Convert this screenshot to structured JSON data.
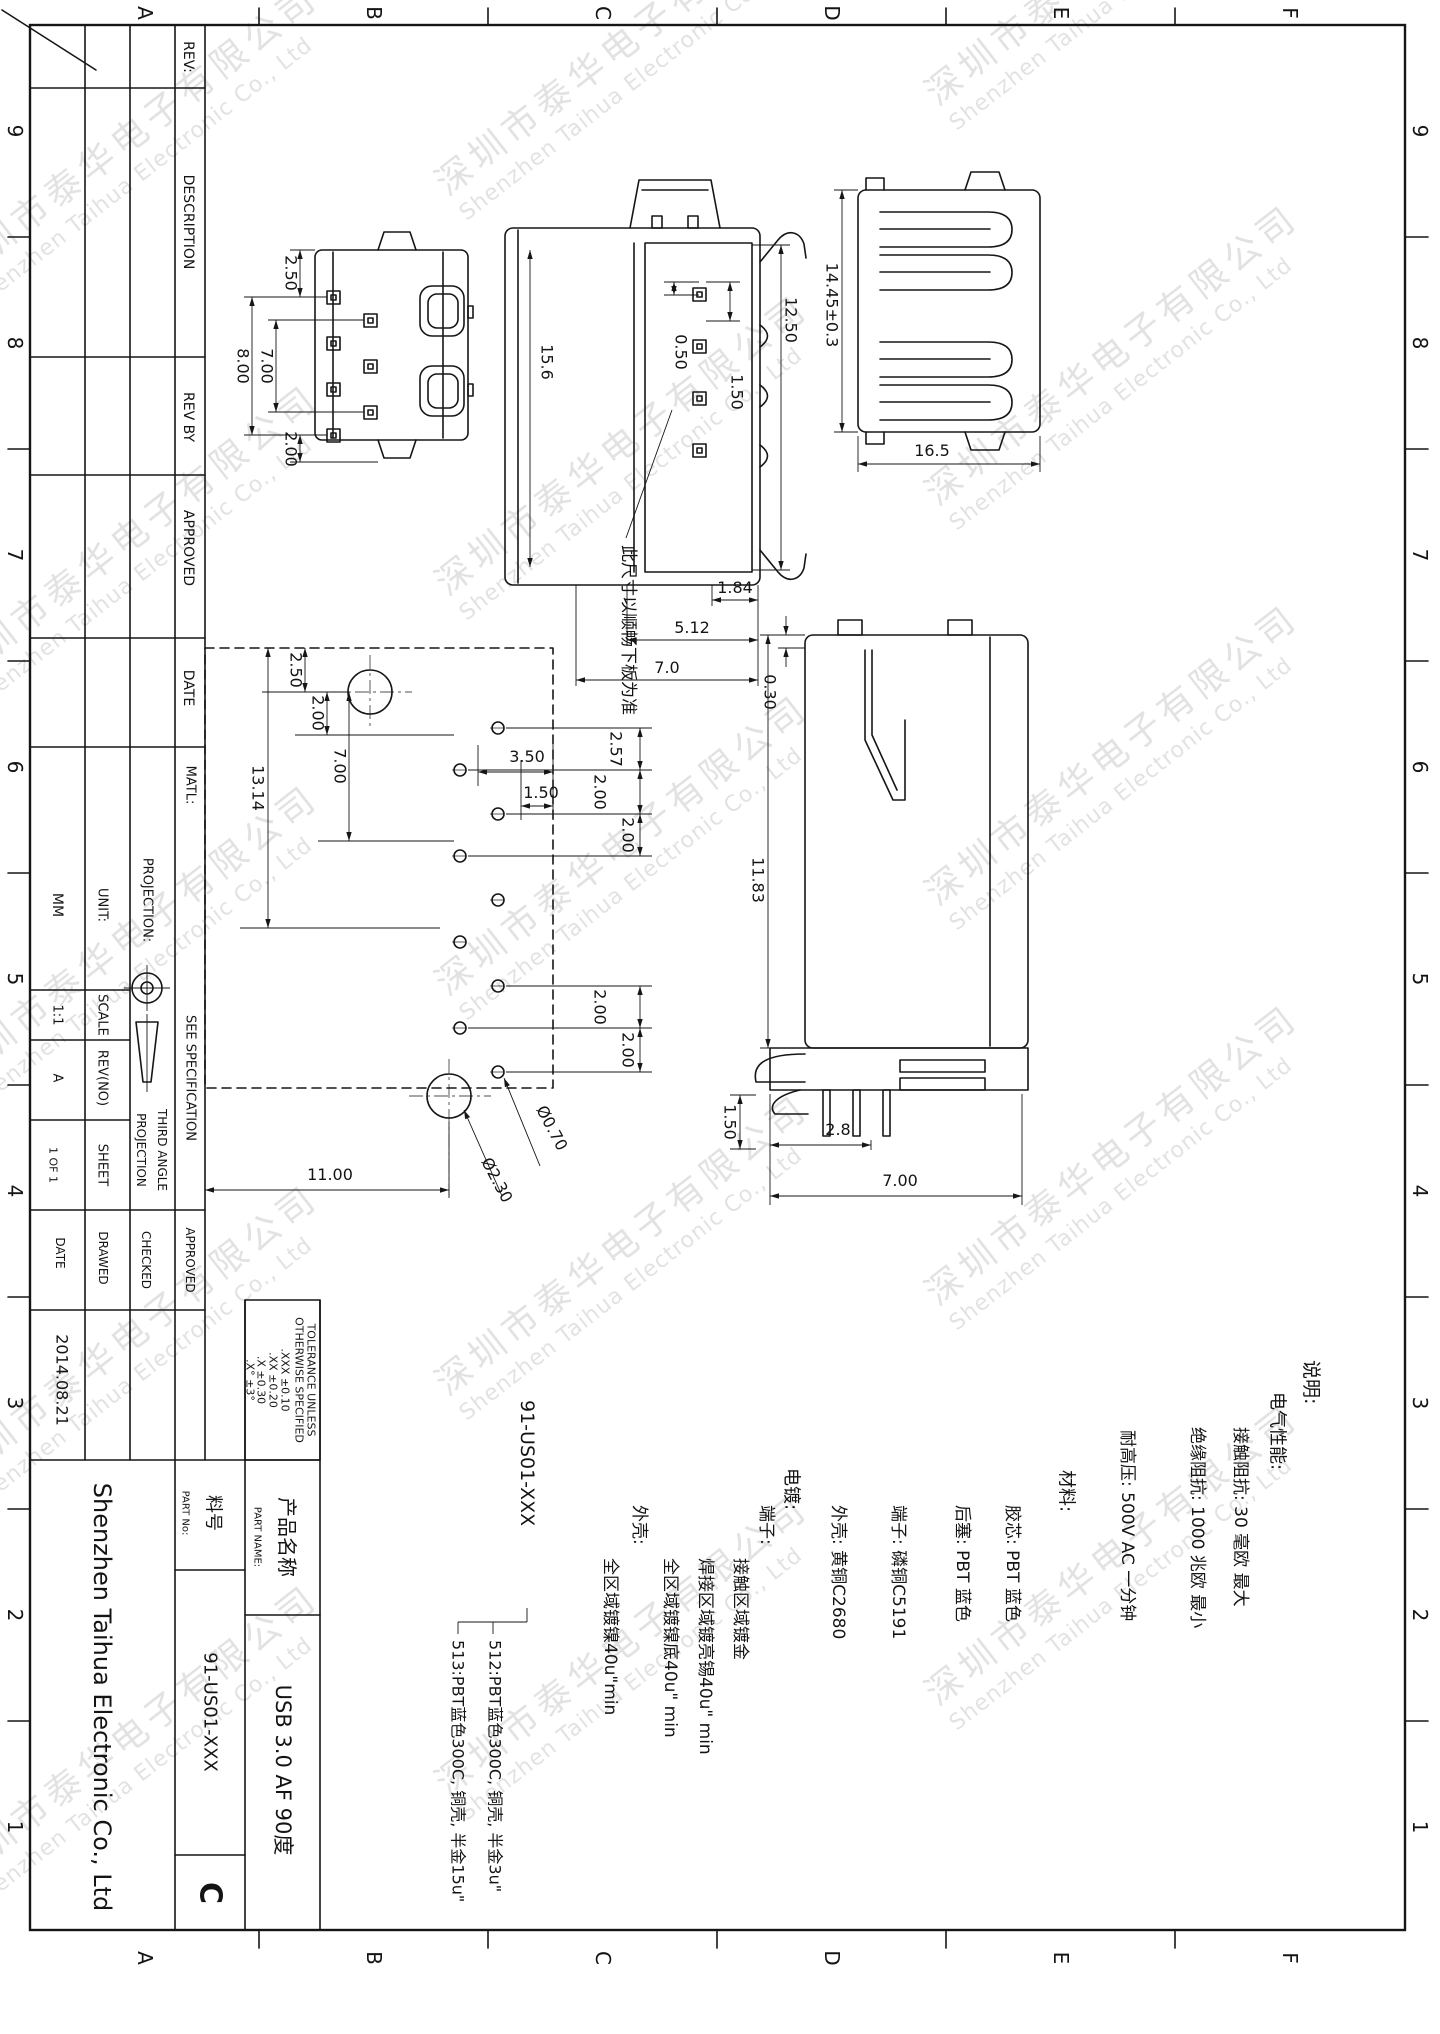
{
  "watermark": {
    "cn": "深圳市泰华电子有限公司",
    "en": "Shenzhen Taihua Electronic Co., Ltd"
  },
  "frame": {
    "letters": [
      "A",
      "B",
      "C",
      "D",
      "E",
      "F"
    ],
    "numbers": [
      "9",
      "8",
      "7",
      "6",
      "5",
      "4",
      "3",
      "2",
      "1"
    ]
  },
  "revision_table": {
    "rev": "REV:",
    "description": "DESCRIPTION",
    "rev_by": "REV BY",
    "approved": "APPROVED",
    "date": "DATE"
  },
  "title_block": {
    "matl_label": "MATL:",
    "matl_value": "SEE SPECIFICATION",
    "projection_label": "PROJECTION:",
    "third_angle_1": "THIRD ANGLE",
    "third_angle_2": "PROJECTION",
    "unit_label": "UNIT:",
    "unit_value": "MM",
    "scale_label": "SCALE",
    "scale_value": "1:1",
    "rev_label": "REV(NO)",
    "rev_value": "A",
    "sheet_label": "SHEET",
    "sheet_value": "1 OF 1",
    "approved_label": "APPROVED",
    "checked_label": "CHECKED",
    "drawn_label": "DRAWED",
    "date_label": "DATE",
    "date_value": "2014.08.21",
    "company": "Shenzhen Taihua Electronic Co., Ltd",
    "part_no_cn": "料号",
    "part_no_en": "PART No:",
    "part_no_value": "91-US01-XXX",
    "size_letter": "C",
    "part_name_cn": "产品名称",
    "part_name_en": "PART NAME:",
    "part_name_value": "USB 3.0 AF 90度",
    "tol": [
      "TOLERANCE UNLESS",
      "OTHERWISE SPECIFIED",
      ".XXX  ±0.10",
      ".XX   ±0.20",
      ".X    ±0.30",
      ".X°    ±3°"
    ]
  },
  "callout": {
    "code": "91-US01-XXX",
    "v512": "512:PBT蓝色300C, 铜壳, 半金3u\"",
    "v513": "513:PBT蓝色300C, 铜壳, 半金15u\""
  },
  "notes": {
    "l1": "说明:",
    "l2": "电气性能:",
    "l3": "接触阻抗:  30 毫欧 最大",
    "l4": "绝缘阻抗:  1000 兆欧 最小",
    "l5": "耐高压:  500V AC 一分钟",
    "l6": "材料:",
    "l7": "胶芯:  PBT 蓝色",
    "l8": "后塞:  PBT 蓝色",
    "l9": "端子:  磷铜C5191",
    "l10": "外壳:  黄铜C2680",
    "l11": "电镀:",
    "l12": "端子:",
    "l13": "接触区域镀金",
    "l14": "焊接区域镀亮锡40u\" min",
    "l15": "全区域镀镍底40u\" min",
    "l16": "外壳:",
    "l17": "全区域镀镍40u\"min"
  },
  "leader_note": "此尺寸以顺畅下板为准",
  "views": {
    "rear": {
      "dims": [
        "2.50",
        "8.00",
        "7.00",
        "2.00"
      ]
    },
    "front": {
      "dims": [
        "15.6",
        "0.50",
        "1.50",
        "12.50",
        "1.84",
        "5.12",
        "7.0"
      ]
    },
    "side": {
      "dims": [
        "14.45±0.3",
        "16.5"
      ]
    },
    "footprint": {
      "top": [
        "3.50",
        "1.50"
      ],
      "left": [
        "2.50",
        "2.00",
        "7.00",
        "13.14"
      ],
      "right": [
        "2.57",
        "2.00",
        "2.00",
        "2.00",
        "2.00"
      ],
      "bottom": "11.00",
      "hole_small": "Ø0.70",
      "hole_big": "Ø2.30"
    },
    "profile": {
      "dims": [
        "0.30",
        "11.83",
        "1.50",
        "2.8",
        "7.00"
      ]
    }
  }
}
